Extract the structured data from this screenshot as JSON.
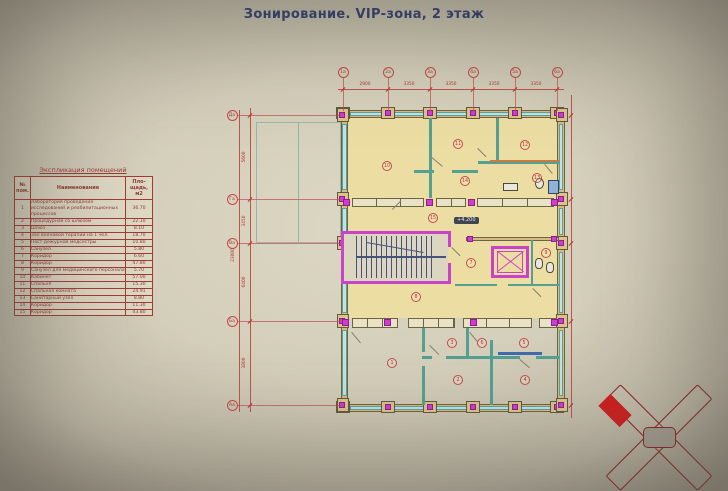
{
  "title": "Зонирование. VIP-зона, 2 этаж",
  "explication": {
    "caption": "Экспликация помещений",
    "col_headers": {
      "num": "№ пом.",
      "name": "Наименование",
      "area": "Пло-щадь, м2"
    },
    "rows": [
      {
        "num": "1",
        "name": "Лаборатория проведения исследований и реабилитационных процессов",
        "area": "36.70"
      },
      {
        "num": "2",
        "name": "Процедурная со шлюзом",
        "area": "22.10"
      },
      {
        "num": "3",
        "name": "Шлюз",
        "area": "8.10"
      },
      {
        "num": "4",
        "name": "Зал волновой терапии на 1 чел.",
        "area": "18.70"
      },
      {
        "num": "5",
        "name": "Пост дежурной медсестры",
        "area": "10.80"
      },
      {
        "num": "6",
        "name": "Санузел",
        "area": "5.80"
      },
      {
        "num": "7",
        "name": "Коридор",
        "area": "6.60"
      },
      {
        "num": "8",
        "name": "Коридор",
        "area": "47.80"
      },
      {
        "num": "9",
        "name": "Санузел для медицинского персонала",
        "area": "5.70"
      },
      {
        "num": "10",
        "name": "Кабинет",
        "area": "57.00"
      },
      {
        "num": "11",
        "name": "Спальня",
        "area": "15.30"
      },
      {
        "num": "12",
        "name": "Спальная комната",
        "area": "24.91"
      },
      {
        "num": "13",
        "name": "Санитарный узел",
        "area": "8.80"
      },
      {
        "num": "14",
        "name": "Коридор",
        "area": "11.30"
      },
      {
        "num": "15",
        "name": "Коридор",
        "area": "43.80"
      }
    ]
  },
  "plan": {
    "top_axes": [
      "1а",
      "2а",
      "3а",
      "4а",
      "5а",
      "6а"
    ],
    "top_dims": [
      "2900",
      "3350",
      "3350",
      "3350",
      "3350"
    ],
    "left_axes": [
      "Да",
      "Га",
      "Ва",
      "Ба",
      "Аа"
    ],
    "left_dims": [
      "5600",
      "3450",
      "6400",
      "3800"
    ],
    "left_total_dim": "23000",
    "rooms": [
      "1",
      "2",
      "3",
      "4",
      "5",
      "6",
      "7",
      "8",
      "9",
      "10",
      "11",
      "12",
      "13",
      "14",
      "15"
    ],
    "elevation_badge": "+4.200"
  },
  "colors": {
    "title": "#2c3b72",
    "table_red": "#a03c36",
    "axis_red": "#c34a4a",
    "wall_tan": "#d7bb82",
    "partition_teal": "#55a091",
    "accent_magenta": "#c943c9",
    "zone_yellow": "#ecdea3",
    "keyplan_red": "#cc1f1f"
  }
}
